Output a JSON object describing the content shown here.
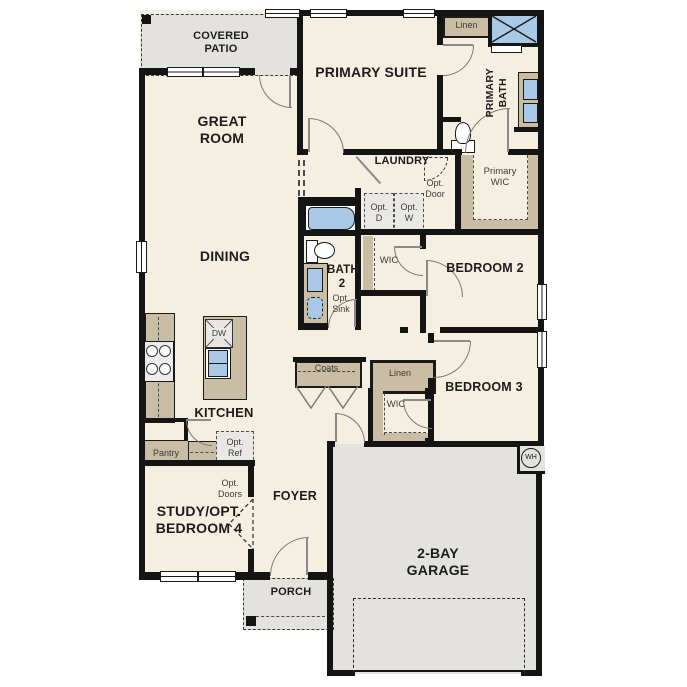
{
  "plan": {
    "rooms": {
      "covered_patio": "COVERED PATIO",
      "great_room": "GREAT ROOM",
      "primary_suite": "PRIMARY SUITE",
      "primary_bath": "PRIMARY BATH",
      "primary_wic": "Primary WIC",
      "laundry": "LAUNDRY",
      "dining": "DINING",
      "bath2": "BATH 2",
      "bedroom2": "BEDROOM 2",
      "bedroom3": "BEDROOM 3",
      "kitchen": "KITCHEN",
      "study": "STUDY/OPT. BEDROOM 4",
      "foyer": "FOYER",
      "porch": "PORCH",
      "garage": "2-BAY GARAGE"
    },
    "closets": {
      "linen_primary": "Linen",
      "linen_hall": "Linen",
      "coats": "Coats",
      "wic_bed2": "WIC",
      "wic_bed3": "WIC",
      "pantry": "Pantry"
    },
    "options": {
      "opt_door": "Opt. Door",
      "opt_dryer": "Opt. D",
      "opt_washer": "Opt. W",
      "opt_sink": "Opt. Sink",
      "opt_ref": "Opt. Ref",
      "opt_doors": "Opt. Doors"
    },
    "fixtures": {
      "dishwasher": "DW",
      "water_heater": "WH"
    },
    "colors": {
      "floor": "#f5efe2",
      "cabinet_tan": "#c9bda4",
      "outdoor_gray": "#e3e2df",
      "fixture_blue": "#aac9e6",
      "wall_black": "#141414"
    }
  }
}
